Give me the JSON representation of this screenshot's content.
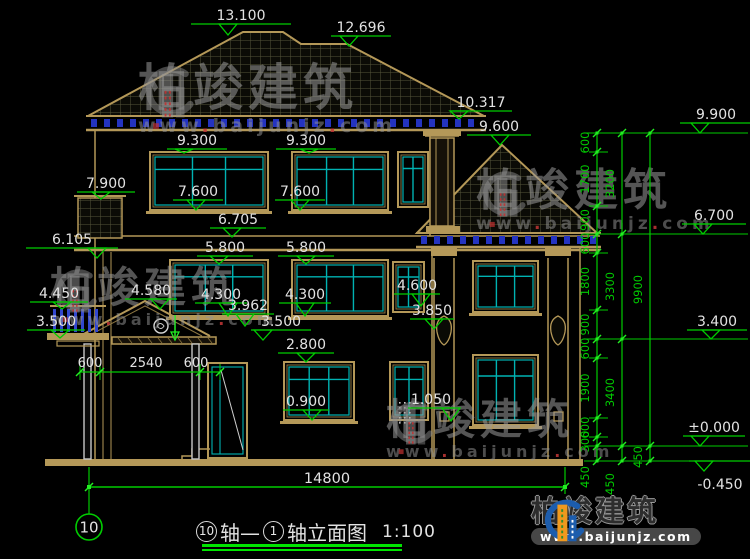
{
  "page": {
    "width": 750,
    "height": 559,
    "background": "#000000"
  },
  "colors": {
    "dim_green": "#00cc00",
    "tick_green": "#22ee22",
    "text_white": "#e2e2e2",
    "tan": "#b49858",
    "tan_dark": "#8a7440",
    "cyan": "#00b2b2",
    "dentil_blue": "#2433c0",
    "baluster_blue": "#3247cf",
    "roof_hatch": "#55553a",
    "watermark_gray": "#8e8e8e",
    "watermark_red": "#c23030",
    "logo_blue": "#1d5dad",
    "logo_orange": "#f0991e",
    "column_gray": "#c8c8c8"
  },
  "elevation_markers": [
    {
      "value": "13.100",
      "cx": 241,
      "ty": 20,
      "ly": 24,
      "ax": 228,
      "ay": 35,
      "lw": 100
    },
    {
      "value": "12.696",
      "cx": 361,
      "ty": 32,
      "ly": 36,
      "ax": 349,
      "ay": 46,
      "lw": 60
    },
    {
      "value": "10.317",
      "cx": 481,
      "ty": 107,
      "ly": 111,
      "ax": 459,
      "ay": 119,
      "lw": 62
    },
    {
      "value": "9.600",
      "cx": 499,
      "ty": 131,
      "ly": 135,
      "ax": 500,
      "ay": 145,
      "lw": 64
    },
    {
      "value": "9.900",
      "cx": 716,
      "ty": 119,
      "ly": 123,
      "ax": 700,
      "ay": 133,
      "lw": 72
    },
    {
      "value": "9.300",
      "cx": 197,
      "ty": 145,
      "ly": 149,
      "ax": 184,
      "ay": 153,
      "lw": 60
    },
    {
      "value": "9.300",
      "cx": 306,
      "ty": 145,
      "ly": 149,
      "ax": 309,
      "ay": 153,
      "lw": 60
    },
    {
      "value": "7.900",
      "cx": 106,
      "ty": 188,
      "ly": 192,
      "ax": 101,
      "ay": 199,
      "lw": 58
    },
    {
      "value": "7.600",
      "cx": 198,
      "ty": 196,
      "ly": 200,
      "ax": 196,
      "ay": 210,
      "lw": 50
    },
    {
      "value": "7.600",
      "cx": 300,
      "ty": 196,
      "ly": 200,
      "ax": 300,
      "ay": 210,
      "lw": 50
    },
    {
      "value": "6.705",
      "cx": 238,
      "ty": 224,
      "ly": 228,
      "ax": 232,
      "ay": 237,
      "lw": 56
    },
    {
      "value": "6.700",
      "cx": 714,
      "ty": 220,
      "ly": 224,
      "ax": 703,
      "ay": 234,
      "lw": 64
    },
    {
      "value": "6.105",
      "cx": 72,
      "ty": 244,
      "ly": 248,
      "ax": 97,
      "ay": 258,
      "lw": 92
    },
    {
      "value": "5.800",
      "cx": 225,
      "ty": 252,
      "ly": 256,
      "ax": 219,
      "ay": 264,
      "lw": 56
    },
    {
      "value": "5.800",
      "cx": 306,
      "ty": 252,
      "ly": 256,
      "ax": 306,
      "ay": 264,
      "lw": 56
    },
    {
      "value": "4.580",
      "cx": 151,
      "ty": 295,
      "ly": 299,
      "ax": 160,
      "ay": 309,
      "lw": 52
    },
    {
      "value": "4.450",
      "cx": 59,
      "ty": 298,
      "ly": 302,
      "ax": 62,
      "ay": 309,
      "lw": 58
    },
    {
      "value": "4.300",
      "cx": 221,
      "ty": 299,
      "ly": 303,
      "ax": 228,
      "ay": 316,
      "lw": 52
    },
    {
      "value": "4.300",
      "cx": 305,
      "ty": 299,
      "ly": 303,
      "ax": 305,
      "ay": 316,
      "lw": 52
    },
    {
      "value": "4.600",
      "cx": 417,
      "ty": 290,
      "ly": 294,
      "ax": 421,
      "ay": 306,
      "lw": 46
    },
    {
      "value": "3.962",
      "cx": 248,
      "ty": 310,
      "ly": 314,
      "ax": 245,
      "ay": 326,
      "lw": 52
    },
    {
      "value": "3.850",
      "cx": 432,
      "ty": 315,
      "ly": 319,
      "ax": 434,
      "ay": 329,
      "lw": 44
    },
    {
      "value": "3.500",
      "cx": 281,
      "ty": 326,
      "ly": 330,
      "ax": 263,
      "ay": 340,
      "lw": 60
    },
    {
      "value": "3.500",
      "cx": 56,
      "ty": 326,
      "ly": 330,
      "ax": 60,
      "ay": 338,
      "lw": 58
    },
    {
      "value": "3.400",
      "cx": 717,
      "ty": 326,
      "ly": 330,
      "ax": 711,
      "ay": 339,
      "lw": 60
    },
    {
      "value": "2.800",
      "cx": 306,
      "ty": 349,
      "ly": 353,
      "ax": 306,
      "ay": 362,
      "lw": 56
    },
    {
      "value": "0.900",
      "cx": 306,
      "ty": 406,
      "ly": 410,
      "ax": 312,
      "ay": 420,
      "lw": 46
    },
    {
      "value": "1.050",
      "cx": 431,
      "ty": 404,
      "ly": 408,
      "ax": 451,
      "ay": 421,
      "lw": 46
    },
    {
      "value": "±0.000",
      "cx": 714,
      "ty": 432,
      "ly": 436,
      "ax": 700,
      "ay": 446,
      "lw": 62
    },
    {
      "value": "-0.450",
      "cx": 720,
      "ty": 489,
      "ly": 461,
      "ax": 704,
      "ay": 471,
      "lw": 62,
      "below": true
    }
  ],
  "right_dim_chain": {
    "top_elevation_mm": 9900,
    "px_y_at_top": 133,
    "px_per_mm": 0.03165,
    "columns": [
      {
        "x": 597,
        "label_x": 589,
        "segments_mm": [
          600,
          1700,
          900,
          600,
          1800,
          900,
          600,
          1900,
          600,
          300,
          450
        ],
        "last_label_y": 477
      },
      {
        "x": 622,
        "label_x": 614,
        "segments_mm": [
          3200,
          3300,
          3400,
          450
        ],
        "last_label_y": 484
      },
      {
        "x": 650,
        "label_x": 642,
        "segments_mm": [
          9900,
          450
        ],
        "last_label_y": 457
      }
    ],
    "level_lines_mm": [
      9900,
      6700,
      3400,
      0,
      -450
    ],
    "minor_tick_mm": [
      9300,
      7600,
      6100,
      4300,
      2800,
      900,
      300
    ]
  },
  "horizontal_dims": {
    "porch": {
      "y": 372,
      "ticks_x": [
        80,
        100,
        200,
        220
      ],
      "labels": [
        {
          "value": "600",
          "cx": 90
        },
        {
          "value": "2540",
          "cx": 146
        },
        {
          "value": "600",
          "cx": 196
        }
      ]
    },
    "overall": {
      "value": "14800",
      "y": 487,
      "x1": 89,
      "x2": 565,
      "label_cx": 327,
      "label_y": 483
    }
  },
  "axis_bubble": {
    "number": "10",
    "cx": 89,
    "cy": 527,
    "r": 13
  },
  "title_block": {
    "axis_a": "10",
    "mid_text": "轴—",
    "axis_b": "1",
    "suffix_text": "轴立面图",
    "scale": "1:100"
  },
  "watermarks": [
    {
      "brand": "柏竣建筑",
      "url": "www.baijunjz.com",
      "x": 138,
      "y": 62,
      "brand_size": 50,
      "url_size": 19
    },
    {
      "brand": "柏竣建筑",
      "url": "www.baijunjz.com",
      "x": 476,
      "y": 168,
      "brand_size": 44,
      "url_size": 17
    },
    {
      "brand": "柏竣建筑",
      "url": "www.baijunjz.com",
      "x": 50,
      "y": 266,
      "brand_size": 42,
      "url_size": 16
    },
    {
      "brand": "柏竣建筑",
      "url": "www.baijunjz.com",
      "x": 386,
      "y": 398,
      "brand_size": 42,
      "url_size": 16
    }
  ],
  "footer_logo": {
    "brand": "柏竣建筑",
    "url": "www.baijunjz.com"
  }
}
